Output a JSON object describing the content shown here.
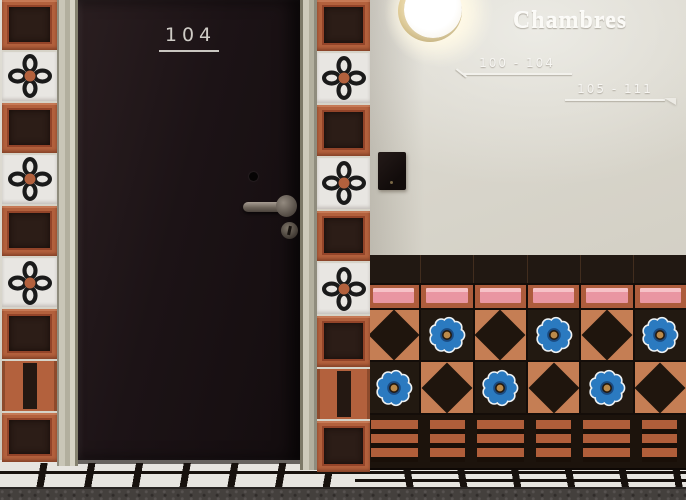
{
  "door": {
    "number": "104"
  },
  "signage": {
    "title": "Chambres",
    "left_range": "100 - 104",
    "right_range": "105 - 111"
  },
  "fixtures": {
    "lamp": "glowing-globe-sconce",
    "card_reader": "key-card-reader"
  },
  "palette": {
    "wall": "#d9d6cc",
    "door": "#1b1215",
    "trim": "#bdbaa9",
    "tile_terracotta": "#b3613d",
    "tile_dark_center": "#2c1d17",
    "tile_white": "#e8e6e2",
    "wainscot_terracotta": "#c57e54",
    "wainscot_dark": "#211812",
    "pink": "#e996a2",
    "blue_flower": "#2b7ac0",
    "flower_center_gold": "#bb8a4a",
    "floor_white": "#e7e5e0",
    "floor_line": "#17110d",
    "carpet": "#44403d"
  },
  "left_column": {
    "tiles": [
      "terracotta",
      "flower",
      "terracotta",
      "flower",
      "terracotta",
      "flower",
      "terracotta",
      "bar",
      "terracotta"
    ]
  },
  "right_column": {
    "tiles": [
      "terracotta",
      "flower",
      "terracotta",
      "flower",
      "terracotta",
      "flower",
      "terracotta",
      "bar",
      "terracotta"
    ]
  },
  "wainscot": {
    "rows": [
      {
        "type": "dark",
        "cells": 6
      },
      {
        "type": "pink",
        "cells": 6
      },
      {
        "type": "p1",
        "cells": [
          "diamond",
          "flower",
          "diamond",
          "flower",
          "diamond",
          "flower"
        ]
      },
      {
        "type": "p2",
        "cells": [
          "flower",
          "diamond",
          "flower",
          "diamond",
          "flower",
          "diamond"
        ]
      },
      {
        "type": "stripes",
        "cells": 6
      }
    ]
  }
}
